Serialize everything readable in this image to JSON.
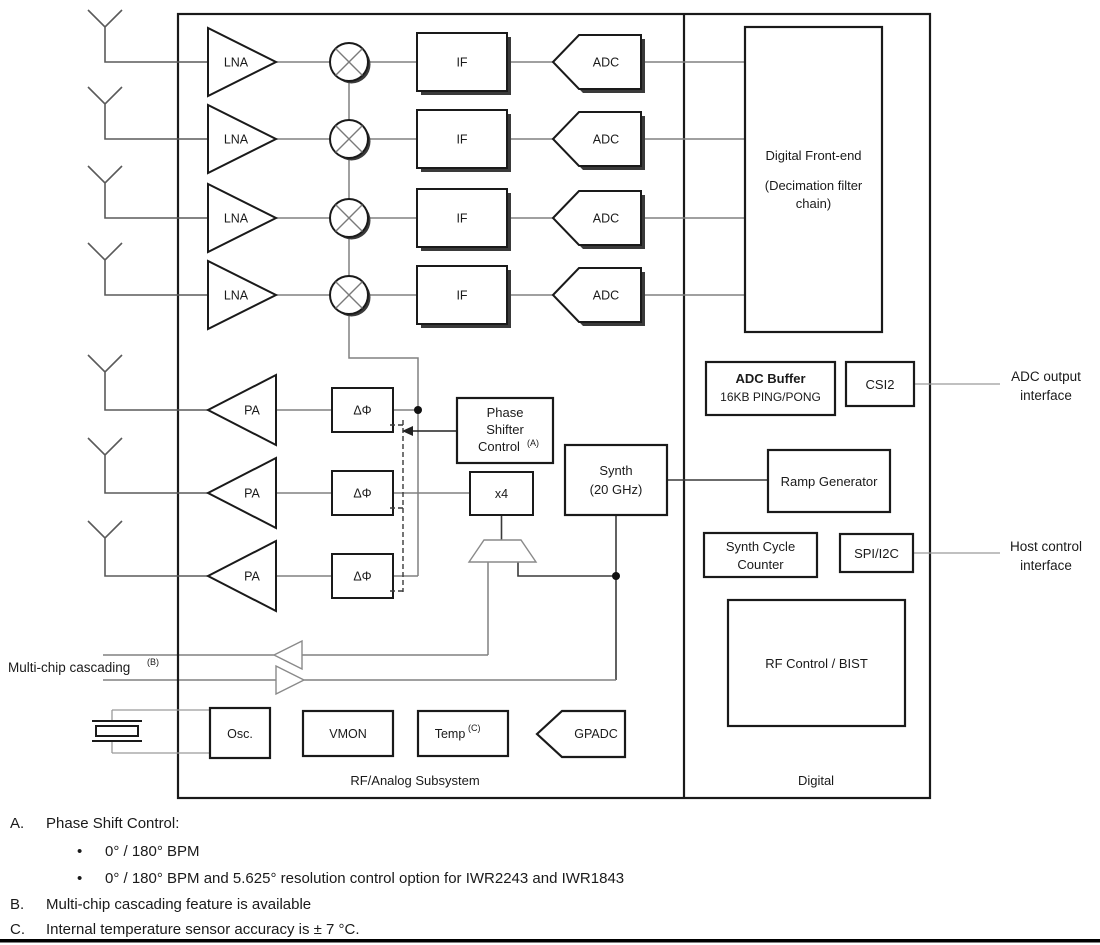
{
  "colors": {
    "border": "#1a1a1a",
    "wire": "#808080",
    "shadow": "#3a3a3a",
    "text": "#1a1a1a",
    "background": "#ffffff"
  },
  "blocks": {
    "lna": "LNA",
    "if": "IF",
    "adc": "ADC",
    "pa": "PA",
    "phase_shifter": "ΔΦ",
    "x4": "x4",
    "digital_front_end": {
      "line1": "Digital Front-end",
      "line2": "(Decimation filter",
      "line3": "chain)"
    },
    "phase_shifter_control": {
      "line1": "Phase",
      "line2": "Shifter",
      "line3": "Control",
      "sup": "(A)"
    },
    "synth": {
      "line1": "Synth",
      "line2": "(20 GHz)"
    },
    "adc_buffer": {
      "title": "ADC Buffer",
      "subtitle": "16KB PING/PONG"
    },
    "csi2": "CSI2",
    "ramp_generator": "Ramp Generator",
    "synth_cycle_counter": {
      "line1": "Synth Cycle",
      "line2": "Counter"
    },
    "spi_i2c": "SPI/I2C",
    "rf_control_bist": "RF Control / BIST",
    "osc": "Osc.",
    "vmon": "VMON",
    "temp": {
      "text": "Temp",
      "sup": "(C)"
    },
    "gpadc": "GPADC"
  },
  "sections": {
    "rf_analog": "RF/Analog Subsystem",
    "digital": "Digital"
  },
  "external": {
    "adc_output": {
      "line1": "ADC output",
      "line2": "interface"
    },
    "host_control": {
      "line1": "Host control",
      "line2": "interface"
    },
    "multichip": {
      "text": "Multi-chip cascading",
      "sup": "(B)"
    }
  },
  "notes": {
    "a": {
      "label": "A.",
      "text": "Phase Shift Control:"
    },
    "bullet": "•",
    "a_items": [
      "0° / 180° BPM",
      "0° / 180° BPM and 5.625° resolution control option for IWR2243 and IWR1843"
    ],
    "b": {
      "label": "B.",
      "text": "Multi-chip cascading feature is available"
    },
    "c": {
      "label": "C.",
      "text": "Internal temperature sensor accuracy is ± 7 °C."
    }
  }
}
